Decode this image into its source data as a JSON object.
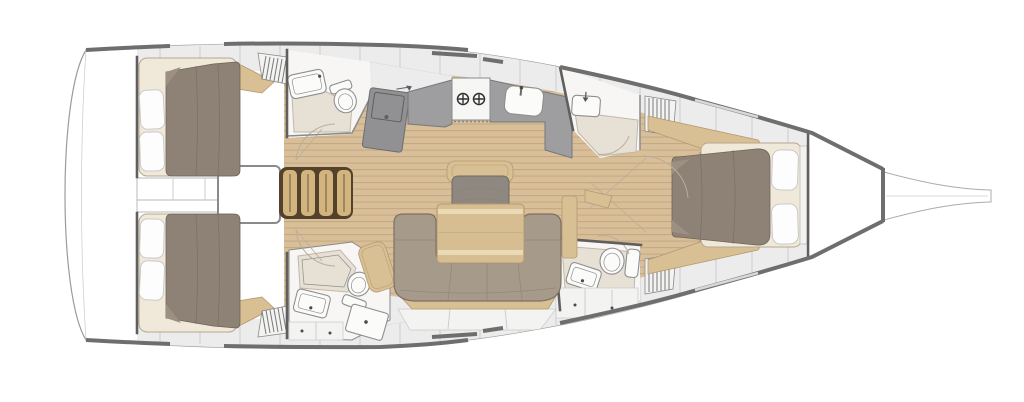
{
  "figure": {
    "kind": "sailing-yacht interior layout plan, top view, bow pointing right",
    "text_visible": "none"
  },
  "colors": {
    "page": "#ffffff",
    "white": "#ffffff",
    "hull_outline": "#9b9b9b",
    "toe_rail": "#6e6e6e",
    "rail_gap": "#d8d8d8",
    "panel": "#ececed",
    "panel_seam": "#c9c9ca",
    "locker": "#f3f3f2",
    "room": "#f7f6f4",
    "wood": "#d9bf99",
    "wood_line": "#c3a87e",
    "trim": "#d9c094",
    "trim_edge": "#b49a6e",
    "steps": "#d2b47f",
    "steps_dark": "#54412c",
    "duvet": "#8e8175",
    "duvet_line": "#6f6458",
    "duvet_fold": "#9c9082",
    "mattress": "#f0e9da",
    "mattress_edge": "#b5a78f",
    "pillow": "#fdfdfd",
    "pillow_edge": "#c9c9c9",
    "settee": "#a69a8b",
    "settee_edge": "#7b7164",
    "settee_seam": "#8d8174",
    "cushion": "#8f8880",
    "cushion_edge": "#6f6962",
    "table": "#d7bd92",
    "table_stripe": "#ead9b5",
    "counter": "#9e9ea0",
    "counter_edge": "#77777a",
    "nav": "#919194",
    "nav_edge": "#6d6d70",
    "stove": "#f6f6f4",
    "burner": "#2f2f2f",
    "head_floor": "#e7e0d5",
    "head_floor_edge": "#c2b8a8",
    "fixture": "#fbfbfa",
    "fixture_edge": "#8f8f8f",
    "bulkhead": "#5f5f5f",
    "wall": "#8a8a8a",
    "door_arc": "#b9ad9c",
    "louver_line": "#7a7a7a"
  },
  "regions": [
    {
      "id": "transom-lazarette",
      "name": "stern transom / lazarette"
    },
    {
      "id": "aft-cabin-port",
      "name": "aft double cabin (top)"
    },
    {
      "id": "aft-cabin-starboard",
      "name": "aft double cabin (bottom)"
    },
    {
      "id": "corridor-cabinets",
      "name": "centreline cabinets between aft cabins"
    },
    {
      "id": "engine-box",
      "name": "engine compartment box"
    },
    {
      "id": "companionway-steps",
      "name": "companionway steps"
    },
    {
      "id": "aft-head-port",
      "name": "aft head with sink and toilet (top)"
    },
    {
      "id": "aft-head-starboard",
      "name": "aft head with shower, sink and toilet (bottom)"
    },
    {
      "id": "nav-station",
      "name": "chart table unit"
    },
    {
      "id": "galley",
      "name": "galley with twin-burner stove and sink"
    },
    {
      "id": "salon-dinette",
      "name": "salon U-settee, chair and table"
    },
    {
      "id": "fwd-head-port",
      "name": "forward head with sink (top)"
    },
    {
      "id": "fwd-head-starboard",
      "name": "forward head with toilet and sink (bottom)"
    },
    {
      "id": "forward-cabin",
      "name": "forward owner cabin with island bed"
    },
    {
      "id": "anchor-locker",
      "name": "anchor locker"
    },
    {
      "id": "bowsprit",
      "name": "bowsprit / stem fitting"
    }
  ]
}
